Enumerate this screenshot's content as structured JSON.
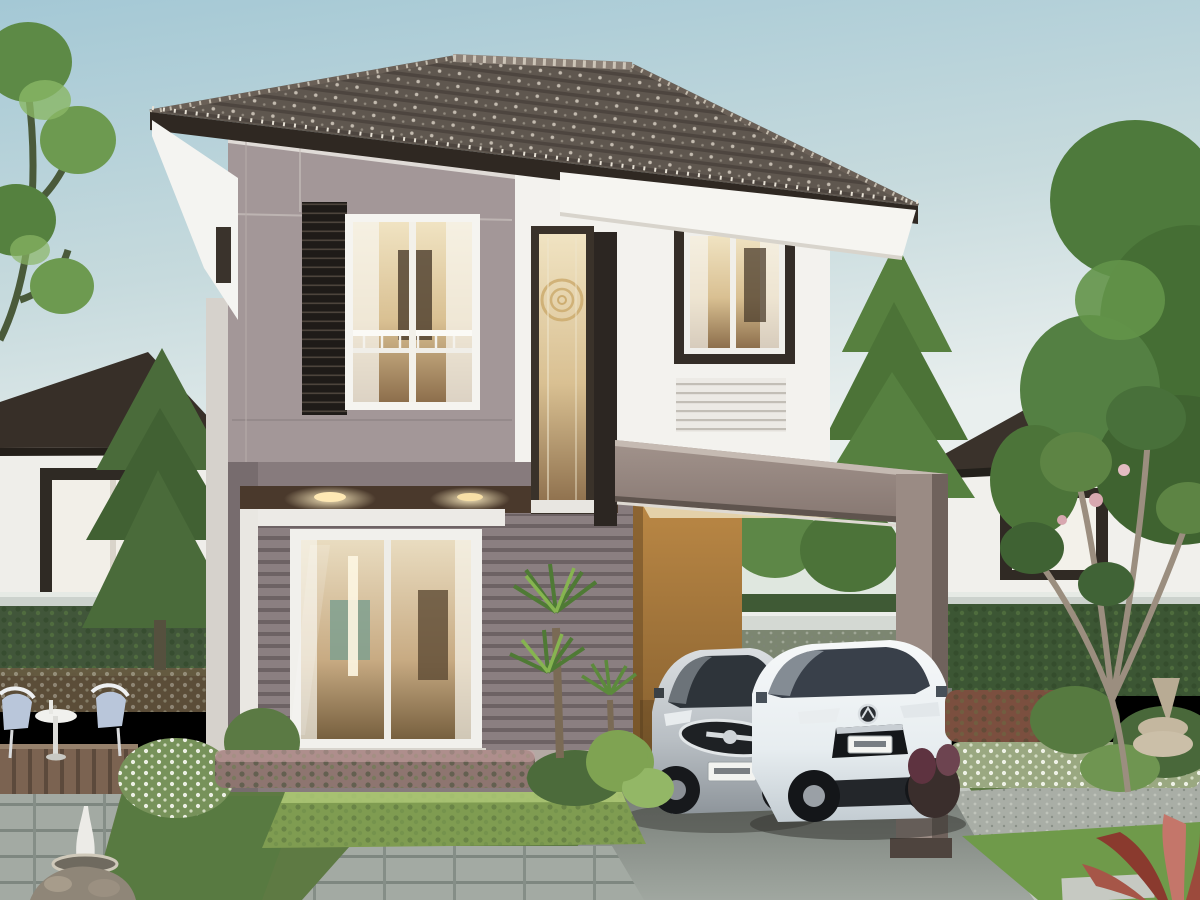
{
  "scene": {
    "description": "Daylight exterior photo of a modern two-storey house with grey-taupe and white walls, a dark hipped tile roof, an attached carport sheltering a silver sedan and a white Mazda SUV, and a landscaped front garden with a seating deck, fountain, trimmed hedges, yuccas and frangipani trees; similar houses are visible in the background.",
    "setting": "residential estate, daytime",
    "palette": {
      "sky_top": "#a9cbd6",
      "sky_horizon": "#edf1ef",
      "roof_tile": "#5a5048",
      "roof_fascia": "#2f2822",
      "wall_taupe_upper": "#a39798",
      "wall_taupe_siding": "#8b7f81",
      "wall_white": "#f3f2ee",
      "trim_white": "#eceae6",
      "window_frame_dark": "#332d27",
      "window_interior_glow": "#e6d3a8",
      "carport_beam": "#9a8b84",
      "carport_wall_ochre": "#b5813f",
      "downlight_warm": "#f3cf8e",
      "sedan_silver": "#c6cbcf",
      "suv_white": "#eef1f2",
      "foliage_dark": "#3f5c33",
      "foliage_light": "#7fa352",
      "lawn": "#6f9a4a",
      "driveway": "#8a908a",
      "deck_wood": "#7b6351"
    }
  },
  "objects": {
    "sky": {
      "label": "pale blue sky"
    },
    "background_house_left": {
      "label": "neighbouring house at left"
    },
    "background_house_right": {
      "label": "neighbouring house at right"
    },
    "fence": {
      "label": "light grey boundary fence rail"
    },
    "background_trees": {
      "label": "garden trees behind the house"
    },
    "main_house": {
      "label": "two-storey show house"
    },
    "roof": {
      "label": "dark hipped concrete-tile roof"
    },
    "upper_window_left": {
      "label": "upstairs bedroom window with dark louvre shutter"
    },
    "stair_window": {
      "label": "tall stairwell feature window"
    },
    "upper_window_right": {
      "label": "upstairs window in white wing"
    },
    "vent_louvre": {
      "label": "white wall vent louvre"
    },
    "sliding_door": {
      "label": "ground-floor sliding glass door with lit interior"
    },
    "downlights": {
      "label": "warm soffit downlights"
    },
    "carport": {
      "label": "attached carport with ochre feature wall"
    },
    "sedan": {
      "label": "silver sedan parked in carport",
      "license_plate": "illegible"
    },
    "suv": {
      "label": "white Mazda SUV on driveway",
      "license_plate": "illegible"
    },
    "driveway": {
      "label": "concrete driveway"
    },
    "seating_area": {
      "label": "white garden chairs and table on timber deck"
    },
    "fountain": {
      "label": "small stone garden fountain"
    },
    "flower_bush": {
      "label": "white flowering shrub"
    },
    "front_hedge": {
      "label": "trimmed hedge and flower beds in front of the house"
    },
    "yucca": {
      "label": "yucca plants beside the door"
    },
    "frangipani": {
      "label": "frangipani tree in right garden"
    },
    "lawn": {
      "label": "front lawn with stepping stones"
    },
    "red_plant": {
      "label": "bronze-leaved plant at bottom right"
    }
  }
}
